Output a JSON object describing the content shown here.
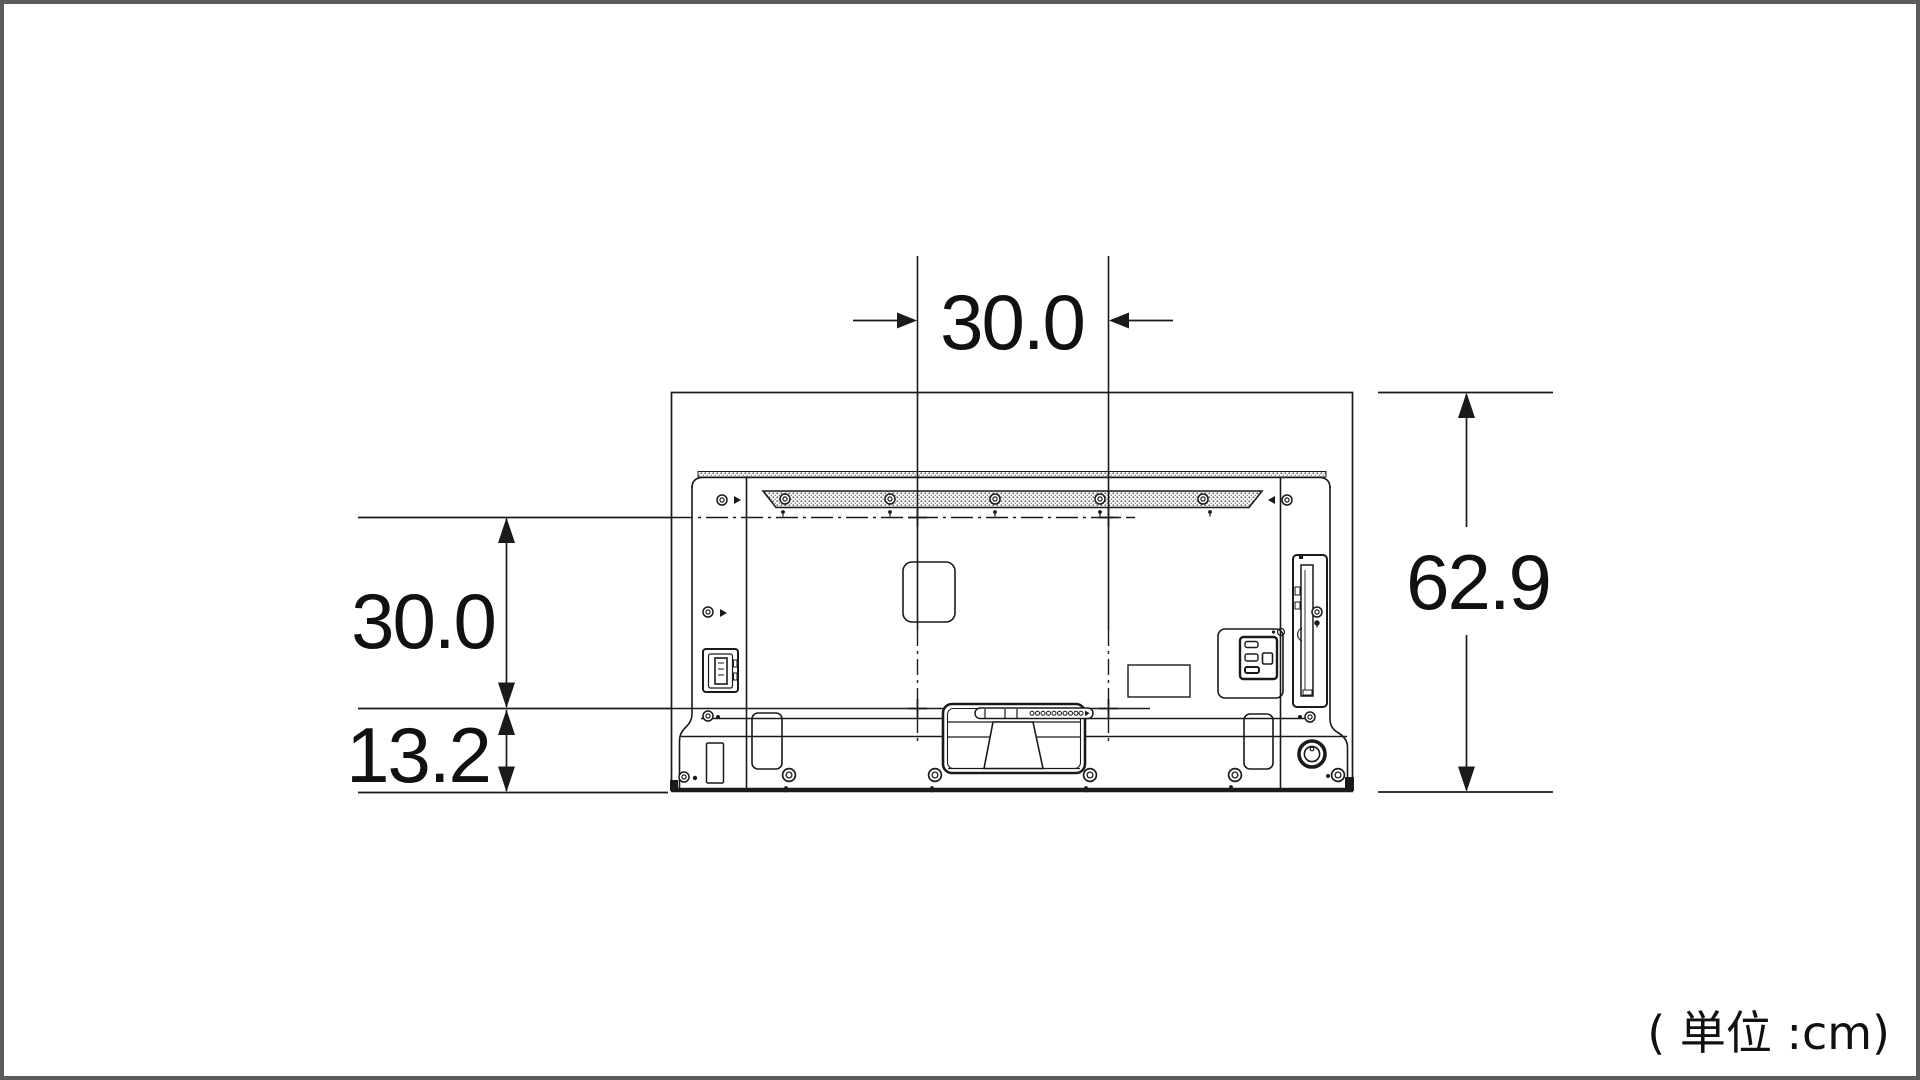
{
  "diagram": {
    "description": "TV rear view dimensional line drawing",
    "unit_note": "( 単位 :cm)",
    "unit": "cm",
    "dimensions": {
      "top_width": "30.0",
      "left_height": "30.0",
      "bottom_offset": "13.2",
      "total_height": "62.9"
    },
    "measurements": [
      {
        "label": "30.0",
        "axis": "horizontal",
        "location": "top"
      },
      {
        "label": "30.0",
        "axis": "vertical",
        "location": "left"
      },
      {
        "label": "13.2",
        "axis": "vertical",
        "location": "left-bottom"
      },
      {
        "label": "62.9",
        "axis": "vertical",
        "location": "right"
      }
    ],
    "colors": {
      "line": "#1a1a1a",
      "frame": "#5c5c5c",
      "background": "#ffffff"
    }
  }
}
